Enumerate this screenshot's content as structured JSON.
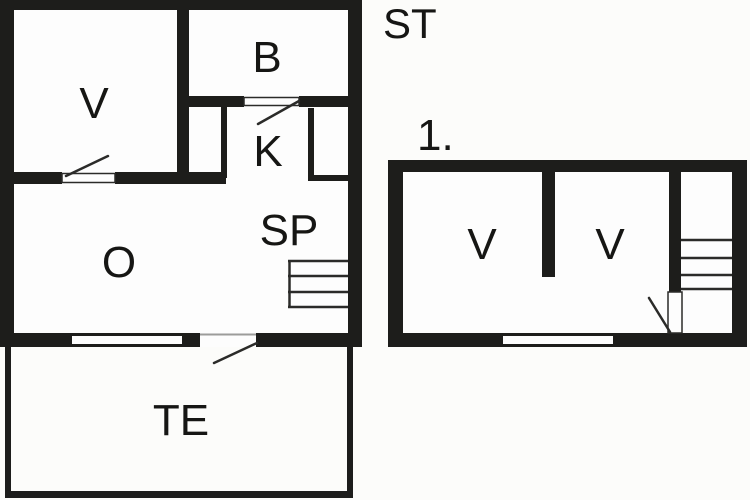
{
  "colors": {
    "wall": "#1d1d1b",
    "background": "#fcfcfa",
    "floor": "#fdfdfd",
    "line": "#2b2b29",
    "faint_line": "#9c9c9a",
    "text": "#161614"
  },
  "floor_plans": {
    "ground_floor": {
      "floor_tag": "ST",
      "rooms": [
        {
          "id": "bedroom",
          "label": "V"
        },
        {
          "id": "bathroom",
          "label": "B"
        },
        {
          "id": "kitchen",
          "label": "K"
        },
        {
          "id": "living-room",
          "label": "O"
        },
        {
          "id": "pantry",
          "label": "SP"
        },
        {
          "id": "terrace",
          "label": "TE"
        }
      ]
    },
    "first_floor": {
      "floor_tag": "1.",
      "rooms": [
        {
          "id": "bedroom-left",
          "label": "V"
        },
        {
          "id": "bedroom-right",
          "label": "V"
        }
      ]
    }
  }
}
